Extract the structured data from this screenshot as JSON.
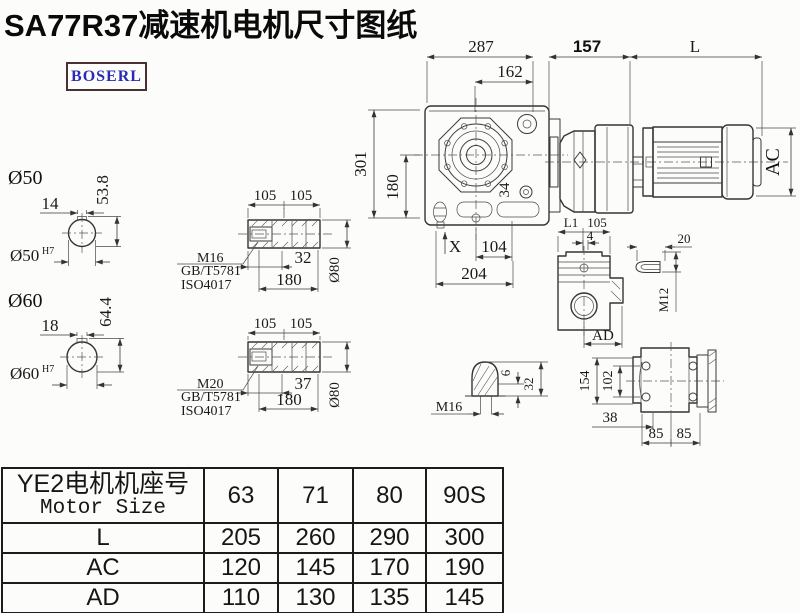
{
  "title": "SA77R37减速机电机尺寸图纸",
  "brand": "BOSERL",
  "colors": {
    "logo_text": "#2b2bb8",
    "logo_border": "#4a3030",
    "drawing_line": "#3a3a3a",
    "text": "#111111"
  },
  "main_view": {
    "dim_287": "287",
    "dim_162": "162",
    "dim_157": "157",
    "dim_L": "L",
    "dim_AC": "AC",
    "dim_301": "301",
    "dim_180": "180",
    "dim_34": "34",
    "dim_X": "X",
    "dim_104": "104",
    "dim_204": "204"
  },
  "shaft_50": {
    "label": "Ø50",
    "key_width": "14",
    "key_height": "53.8",
    "bore": "Ø50",
    "bore_tol": "H7"
  },
  "shaft_60": {
    "label": "Ø60",
    "key_width": "18",
    "key_height": "64.4",
    "bore": "Ø60",
    "bore_tol": "H7"
  },
  "bushing_top": {
    "dim_105a": "105",
    "dim_105b": "105",
    "thread": "M16",
    "std_1": "GB/T5781",
    "std_2": "ISO4017",
    "dim_depth": "32",
    "dim_len": "180",
    "dim_dia": "Ø80"
  },
  "bushing_bottom": {
    "dim_105a": "105",
    "dim_105b": "105",
    "thread": "M20",
    "std_1": "GB/T5781",
    "std_2": "ISO4017",
    "dim_depth": "37",
    "dim_len": "180",
    "dim_dia": "Ø80"
  },
  "side_view": {
    "dim_L1": "L1",
    "dim_105": "105",
    "dim_4": "4",
    "dim_AD": "AD"
  },
  "key_detail": {
    "dim_20": "20",
    "thread": "M12"
  },
  "plug_detail": {
    "thread": "M16",
    "dim_6": "6",
    "dim_32": "32"
  },
  "back_view": {
    "dim_154": "154",
    "dim_102": "102",
    "dim_38": "38",
    "dim_85a": "85",
    "dim_85b": "85"
  },
  "table": {
    "header_cn": "YE2电机机座号",
    "header_en": "Motor Size",
    "columns": [
      "63",
      "71",
      "80",
      "90S"
    ],
    "rows": [
      {
        "label": "L",
        "values": [
          "205",
          "260",
          "290",
          "300"
        ]
      },
      {
        "label": "AC",
        "values": [
          "120",
          "145",
          "170",
          "190"
        ]
      },
      {
        "label": "AD",
        "values": [
          "110",
          "130",
          "135",
          "145"
        ]
      }
    ]
  }
}
